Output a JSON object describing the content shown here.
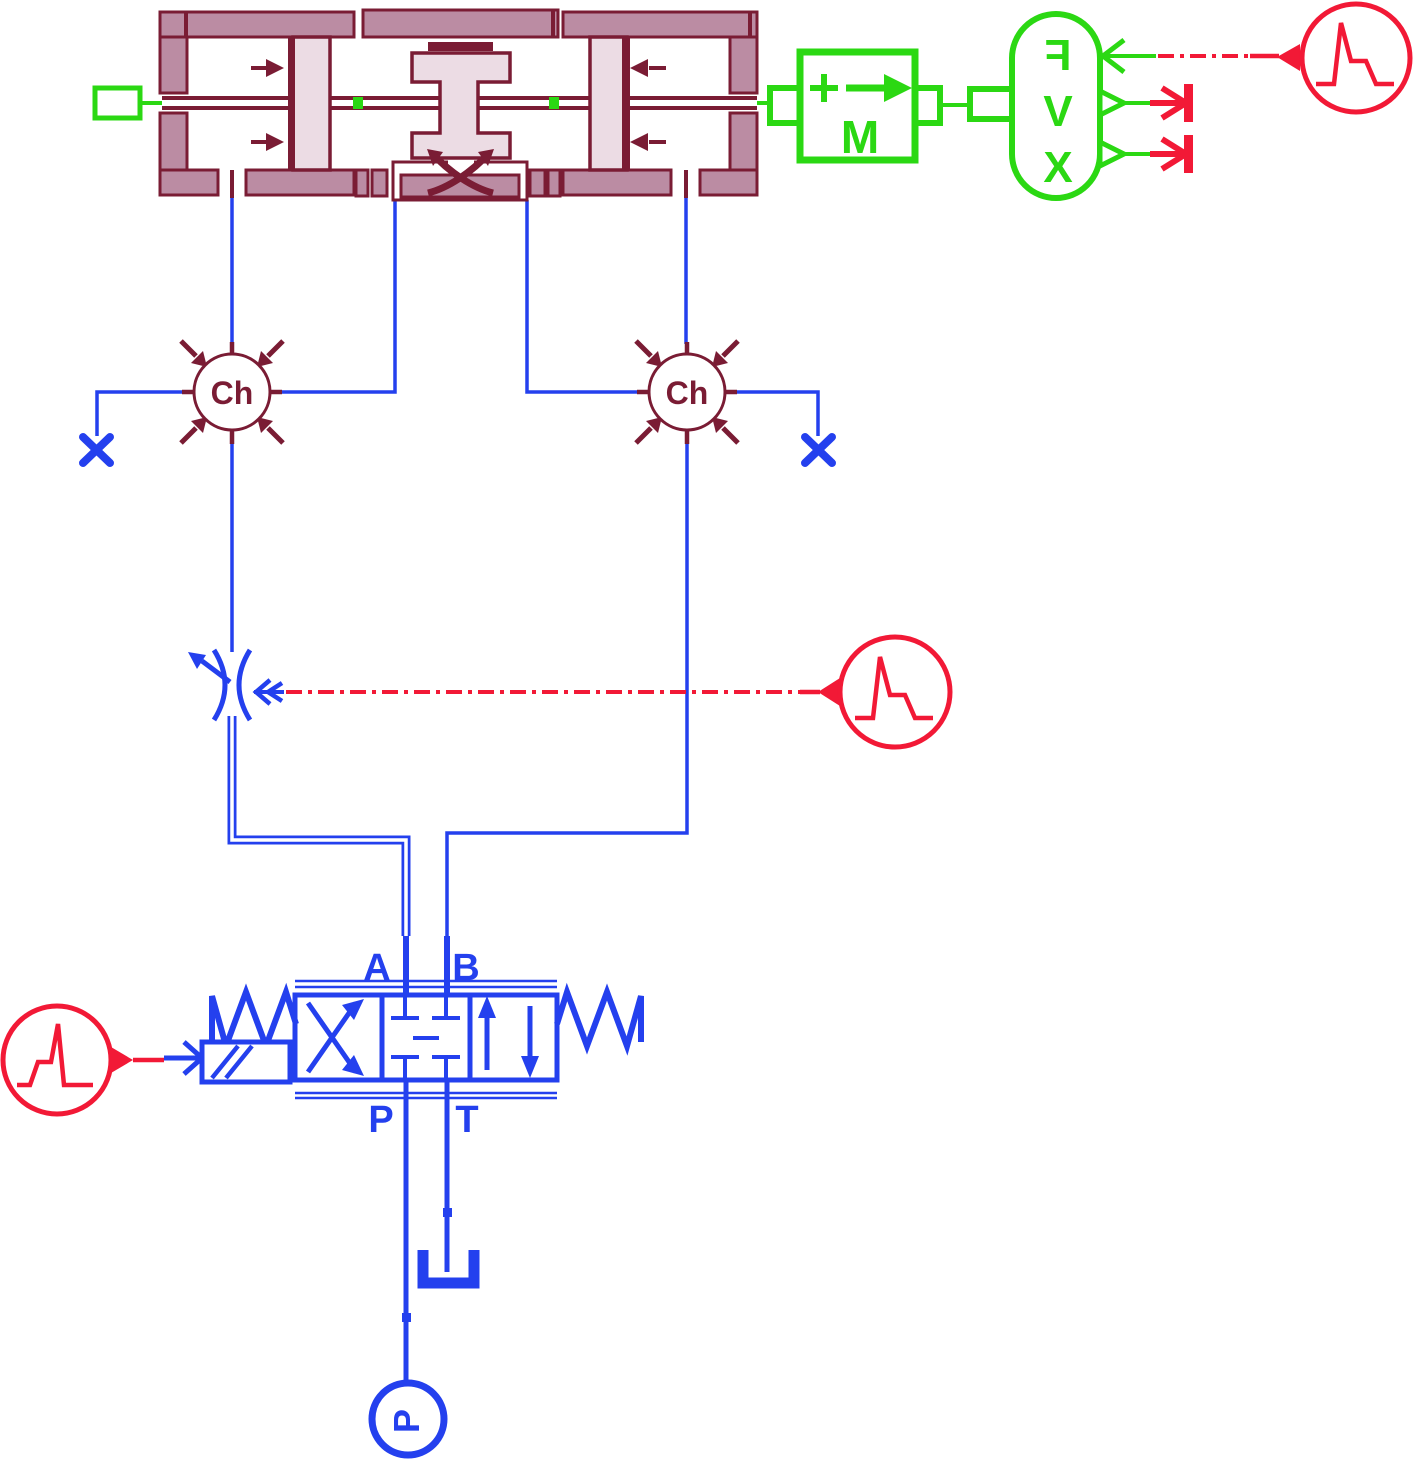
{
  "diagram": {
    "labels": {
      "chamber": "Ch",
      "mass_block": "M",
      "sensor_force": "F",
      "sensor_velocity": "V",
      "sensor_position": "X",
      "valve_port_a": "A",
      "valve_port_b": "B",
      "valve_port_p": "P",
      "valve_port_t": "T",
      "pressure_source": "P"
    },
    "colors": {
      "hydraulic_blue": "#2440ee",
      "mechanical_green": "#2bd813",
      "signal_red": "#f21936",
      "component_maroon": "#7a1c34",
      "component_fill": "#bb8ca3",
      "piston_fill": "#ecdce4"
    }
  }
}
